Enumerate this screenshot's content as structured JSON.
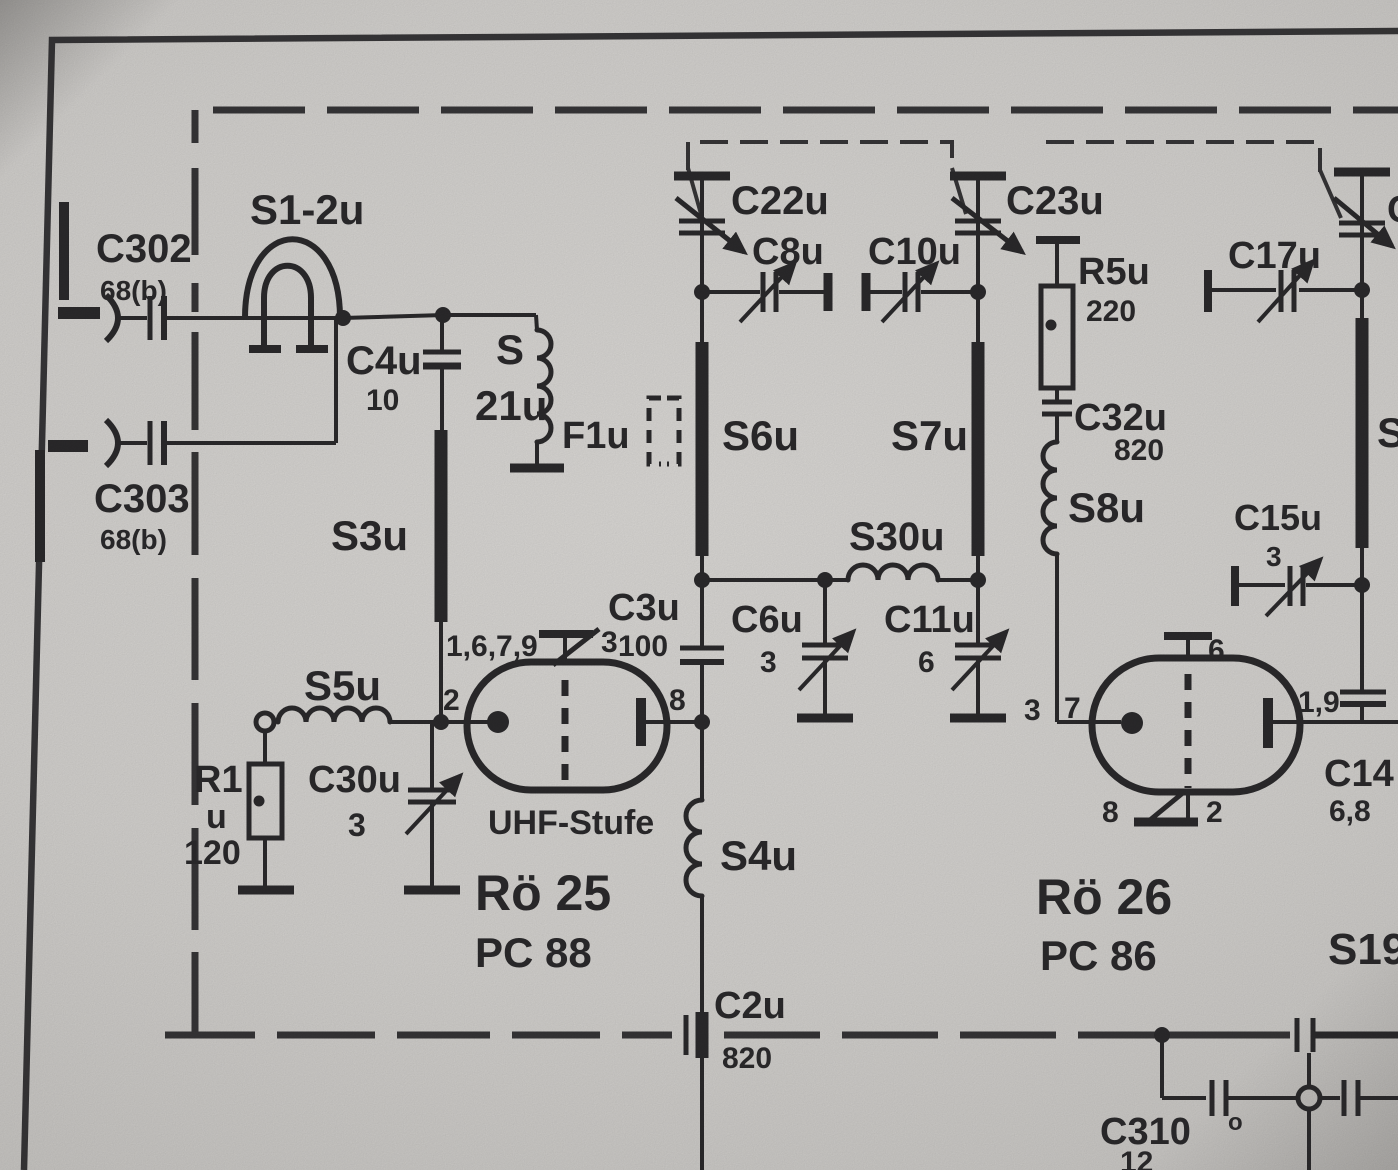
{
  "schematic": {
    "stage_title": "UHF-Stufe",
    "tubes": {
      "ro25": {
        "name": "Rö 25",
        "type": "PC 88",
        "stage": "UHF-Stufe",
        "pin_top": "1,6,7,9",
        "pin_3": "3",
        "pin_2": "2",
        "pin_8": "8"
      },
      "ro26": {
        "name": "Rö 26",
        "type": "PC 86",
        "pin_3": "3",
        "pin_7": "7",
        "pin_6": "6",
        "pin_19": "1,9",
        "pin_8": "8",
        "pin_2": "2"
      }
    },
    "components": {
      "c302": {
        "name": "C302",
        "value": "68(b)"
      },
      "c303": {
        "name": "C303",
        "value": "68(b)"
      },
      "s1_2": {
        "name": "S1-2u"
      },
      "c4": {
        "name": "C4u",
        "value": "10"
      },
      "s21": {
        "prefix": "S",
        "name": "21u"
      },
      "s3": {
        "name": "S3u"
      },
      "s5": {
        "name": "S5u"
      },
      "r1": {
        "name": "R1",
        "unit": "u",
        "value": "120"
      },
      "c30": {
        "name": "C30u",
        "value": "3"
      },
      "f1": {
        "name": "F1u"
      },
      "c22": {
        "name": "C22u"
      },
      "c8": {
        "name": "C8u"
      },
      "c10": {
        "name": "C10u"
      },
      "c23": {
        "name": "C23u"
      },
      "s6": {
        "name": "S6u"
      },
      "s7": {
        "name": "S7u"
      },
      "r5": {
        "name": "R5u",
        "value": "220"
      },
      "c32": {
        "name": "C32u",
        "value": "820"
      },
      "s8": {
        "name": "S8u"
      },
      "c17": {
        "name": "C17u"
      },
      "c15": {
        "name": "C15u",
        "value": "3"
      },
      "s30": {
        "name": "S30u"
      },
      "c3": {
        "name": "C3u",
        "value": "100"
      },
      "c6": {
        "name": "C6u",
        "value": "3"
      },
      "c11": {
        "name": "C11u",
        "value": "6"
      },
      "s4": {
        "name": "S4u"
      },
      "c2": {
        "name": "C2u",
        "value": "820"
      },
      "c310": {
        "name": "C310",
        "mark": "o",
        "value": "12"
      },
      "c14": {
        "name": "C14",
        "value": "6,8"
      },
      "s19": {
        "name": "S19"
      },
      "s_right": {
        "name": "S"
      },
      "c_right": {
        "name": "C"
      }
    }
  }
}
